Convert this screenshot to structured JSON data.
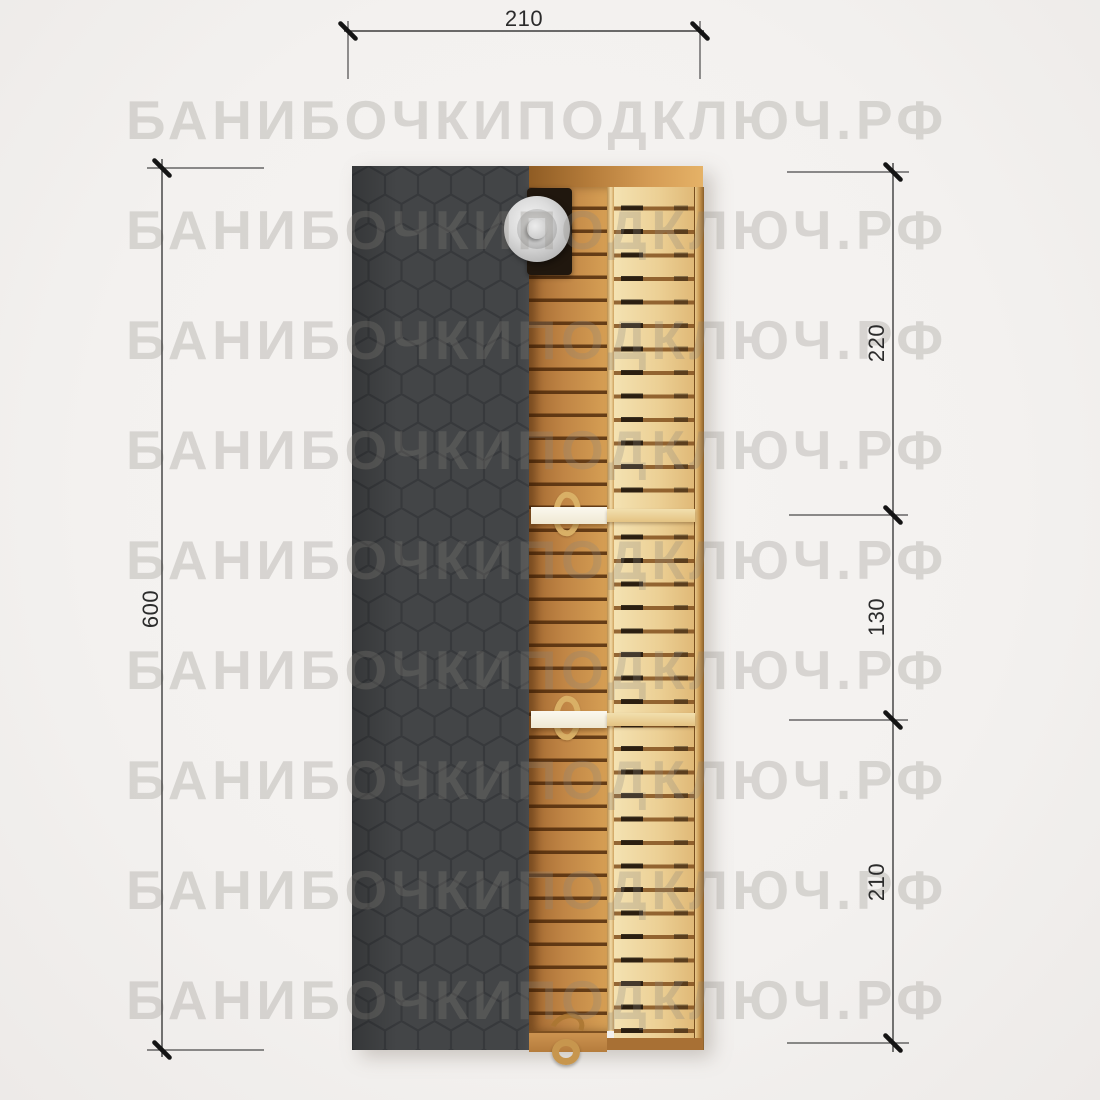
{
  "watermark": {
    "text": "БАНИБОЧКИПОДКЛЮЧ.РФ"
  },
  "dimensions": {
    "top_width": {
      "label": "210"
    },
    "left_length": {
      "label": "600"
    },
    "right_segments": [
      {
        "label": "220"
      },
      {
        "label": "130"
      },
      {
        "label": "210"
      }
    ]
  },
  "colors": {
    "background": "#f3f1ef",
    "roof": "#434547",
    "roof_pattern": "#37393c",
    "wood_mid": "#c08545",
    "wood_light": "#ecd095",
    "bench_white": "#f8f4e9",
    "chimney_cap": "#cfcfcf",
    "dimension_line": "#3c3c3c",
    "watermark_gray": "#8a847e"
  }
}
